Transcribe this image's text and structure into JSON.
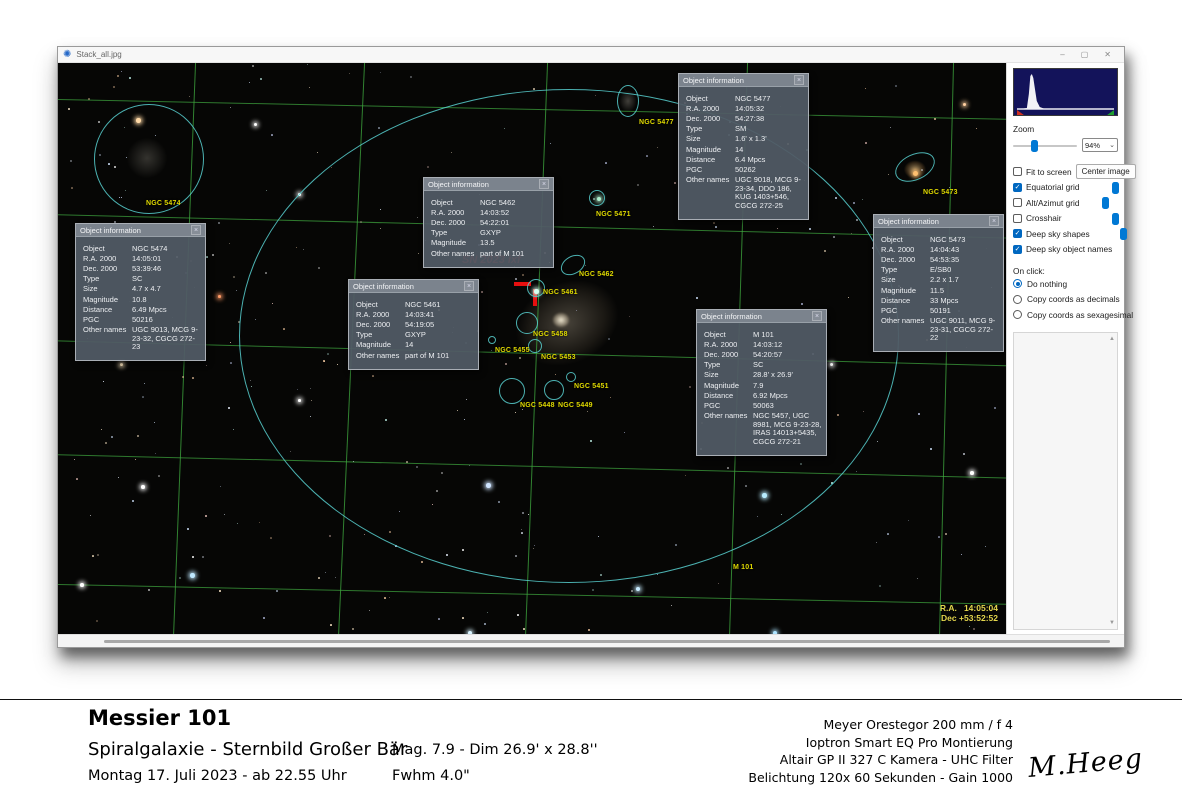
{
  "icons": {
    "app": "✺",
    "minimize": "–",
    "maximize": "▢",
    "close": "✕",
    "popup_close": "×",
    "chevron_down": "⌄",
    "check": "✓",
    "scroll_up": "▲",
    "scroll_down": "▼"
  },
  "window": {
    "title": "Stack_all.jpg"
  },
  "image": {
    "ra_readout": "R.A.   14:05:04",
    "dec_readout": "Dec +53:52:52",
    "sn_label": "SN 2023 ixf",
    "labels": [
      {
        "text": "NGC 5474",
        "x": 88,
        "y": 137
      },
      {
        "text": "NGC 5477",
        "x": 581,
        "y": 56
      },
      {
        "text": "NGC 5471",
        "x": 538,
        "y": 148
      },
      {
        "text": "NGC 5462",
        "x": 521,
        "y": 208
      },
      {
        "text": "NGC 5461",
        "x": 485,
        "y": 226
      },
      {
        "text": "NGC 5458",
        "x": 475,
        "y": 268
      },
      {
        "text": "NGC 5455",
        "x": 437,
        "y": 284
      },
      {
        "text": "NGC 5453",
        "x": 483,
        "y": 291
      },
      {
        "text": "NGC 5451",
        "x": 516,
        "y": 320
      },
      {
        "text": "NGC 5448",
        "x": 462,
        "y": 339
      },
      {
        "text": "NGC 5449",
        "x": 500,
        "y": 339
      },
      {
        "text": "NGC 5473",
        "x": 865,
        "y": 126
      },
      {
        "text": "M 101",
        "x": 675,
        "y": 501
      }
    ],
    "shapes": [
      {
        "name": "M 101 outline",
        "cx": 511,
        "cy": 273,
        "rx": 330,
        "ry": 247,
        "rot": 0
      },
      {
        "name": "NGC 5474",
        "cx": 91,
        "cy": 96,
        "rx": 55,
        "ry": 55,
        "rot": 0
      },
      {
        "name": "NGC 5477",
        "cx": 570,
        "cy": 38,
        "rx": 11,
        "ry": 16,
        "rot": 0
      },
      {
        "name": "NGC 5473",
        "cx": 857,
        "cy": 104,
        "rx": 21,
        "ry": 13,
        "rot": -25
      },
      {
        "name": "NGC 5471",
        "cx": 539,
        "cy": 135,
        "rx": 8,
        "ry": 8,
        "rot": 0
      },
      {
        "name": "NGC 5462",
        "cx": 515,
        "cy": 202,
        "rx": 13,
        "ry": 9,
        "rot": -30
      },
      {
        "name": "NGC 5461",
        "cx": 478,
        "cy": 225,
        "rx": 9,
        "ry": 9,
        "rot": 0
      },
      {
        "name": "NGC 5458",
        "cx": 469,
        "cy": 260,
        "rx": 11,
        "ry": 11,
        "rot": 0
      },
      {
        "name": "NGC 5455",
        "cx": 434,
        "cy": 277,
        "rx": 4,
        "ry": 4,
        "rot": 0
      },
      {
        "name": "NGC 5453",
        "cx": 477,
        "cy": 283,
        "rx": 7,
        "ry": 7,
        "rot": 0
      },
      {
        "name": "NGC 5451",
        "cx": 513,
        "cy": 314,
        "rx": 5,
        "ry": 5,
        "rot": 0
      },
      {
        "name": "NGC 5448",
        "cx": 454,
        "cy": 328,
        "rx": 13,
        "ry": 13,
        "rot": 0
      },
      {
        "name": "NGC 5449",
        "cx": 496,
        "cy": 327,
        "rx": 10,
        "ry": 10,
        "rot": 0
      }
    ],
    "popups": [
      {
        "title": "Object information",
        "x": 17,
        "y": 160,
        "rows": [
          [
            "Object",
            "NGC 5474"
          ],
          [
            "R.A. 2000",
            "14:05:01"
          ],
          [
            "Dec. 2000",
            "53:39:46"
          ],
          [
            "Type",
            "SC"
          ],
          [
            "Size",
            "4.7 x 4.7"
          ],
          [
            "Magnitude",
            "10.8"
          ],
          [
            "Distance",
            "6.49 Mpcs"
          ],
          [
            "PGC",
            "50216"
          ],
          [
            "Other names",
            "UGC 9013, MCG 9-23-32, CGCG 272-23"
          ]
        ]
      },
      {
        "title": "Object information",
        "x": 365,
        "y": 114,
        "rows": [
          [
            "Object",
            "NGC 5462"
          ],
          [
            "R.A. 2000",
            "14:03:52"
          ],
          [
            "Dec. 2000",
            "54:22:01"
          ],
          [
            "Type",
            "GXYP"
          ],
          [
            "Magnitude",
            "13.5"
          ],
          [
            "Other names",
            "part of M 101"
          ]
        ]
      },
      {
        "title": "Object information",
        "x": 290,
        "y": 216,
        "rows": [
          [
            "Object",
            "NGC 5461"
          ],
          [
            "R.A. 2000",
            "14:03:41"
          ],
          [
            "Dec. 2000",
            "54:19:05"
          ],
          [
            "Type",
            "GXYP"
          ],
          [
            "Magnitude",
            "14"
          ],
          [
            "Other names",
            "part of M 101"
          ]
        ]
      },
      {
        "title": "Object information",
        "x": 620,
        "y": 10,
        "rows": [
          [
            "Object",
            "NGC 5477"
          ],
          [
            "R.A. 2000",
            "14:05:32"
          ],
          [
            "Dec. 2000",
            "54:27:38"
          ],
          [
            "Type",
            "SM"
          ],
          [
            "Size",
            "1.6' x 1.3'"
          ],
          [
            "Magnitude",
            "14"
          ],
          [
            "Distance",
            "6.4 Mpcs"
          ],
          [
            "PGC",
            "50262"
          ],
          [
            "Other names",
            "UGC 9018, MCG 9-23-34, DDO 186, KUG 1403+546, CGCG 272-25"
          ]
        ]
      },
      {
        "title": "Object information",
        "x": 815,
        "y": 151,
        "rows": [
          [
            "Object",
            "NGC 5473"
          ],
          [
            "R.A. 2000",
            "14:04:43"
          ],
          [
            "Dec. 2000",
            "54:53:35"
          ],
          [
            "Type",
            "E/SB0"
          ],
          [
            "Size",
            "2.2 x 1.7"
          ],
          [
            "Magnitude",
            "11.5"
          ],
          [
            "Distance",
            "33 Mpcs"
          ],
          [
            "PGC",
            "50191"
          ],
          [
            "Other names",
            "UGC 9011, MCG 9-23-31, CGCG 272-22"
          ]
        ]
      },
      {
        "title": "Object information",
        "x": 638,
        "y": 246,
        "rows": [
          [
            "Object",
            "M 101"
          ],
          [
            "R.A. 2000",
            "14:03:12"
          ],
          [
            "Dec. 2000",
            "54:20:57"
          ],
          [
            "Type",
            "SC"
          ],
          [
            "Size",
            "28.8' x 26.9'"
          ],
          [
            "Magnitude",
            "7.9"
          ],
          [
            "Distance",
            "6.92 Mpcs"
          ],
          [
            "PGC",
            "50063"
          ],
          [
            "Other names",
            "NGC 5457, UGC 8981, MCG 9-23-28, IRAS 14013+5435, CGCG 272-21"
          ]
        ]
      }
    ]
  },
  "sidebar": {
    "zoom_label": "Zoom",
    "zoom_value": "94%",
    "zoom_slider_pos": 0.28,
    "fit_to_screen": "Fit to screen",
    "fit_checked": false,
    "center_image": "Center image",
    "toggles": [
      {
        "label": "Equatorial grid",
        "checked": true,
        "slider": 0.62
      },
      {
        "label": "Alt/Azimut grid",
        "checked": false,
        "slider": 0.4
      },
      {
        "label": "Crosshair",
        "checked": false,
        "slider": 0.88
      },
      {
        "label": "Deep sky shapes",
        "checked": true,
        "slider": 0.58
      },
      {
        "label": "Deep sky object names",
        "checked": true,
        "slider": null
      }
    ],
    "on_click_label": "On click:",
    "radios": [
      {
        "label": "Do nothing",
        "selected": true
      },
      {
        "label": "Copy coords as decimals",
        "selected": false
      },
      {
        "label": "Copy coords as sexagesimal",
        "selected": false
      }
    ]
  },
  "caption": {
    "title": "Messier 101",
    "subtitle": "Spiralgalaxie - Sternbild Großer Bär",
    "date_line": "Montag 17. Juli 2023  -  ab 22.55 Uhr",
    "mag_line": "Mag. 7.9 - Dim 26.9' x 28.8''",
    "fwhm_line": "Fwhm 4.0\"",
    "equipment": [
      "Meyer Orestegor 200 mm /  f 4",
      "Ioptron Smart EQ Pro Montierung",
      "Altair GP II 327 C Kamera - UHC Filter",
      "Belichtung 120x 60 Sekunden - Gain 1000"
    ],
    "signature": "M.Heeg"
  },
  "colors": {
    "grid": "#3ea53e",
    "shape": "#58d0d0",
    "label": "#dfd900",
    "sn_marker": "#e60f0f",
    "accent": "#0067c0",
    "histogram_bg": "#13135a"
  }
}
